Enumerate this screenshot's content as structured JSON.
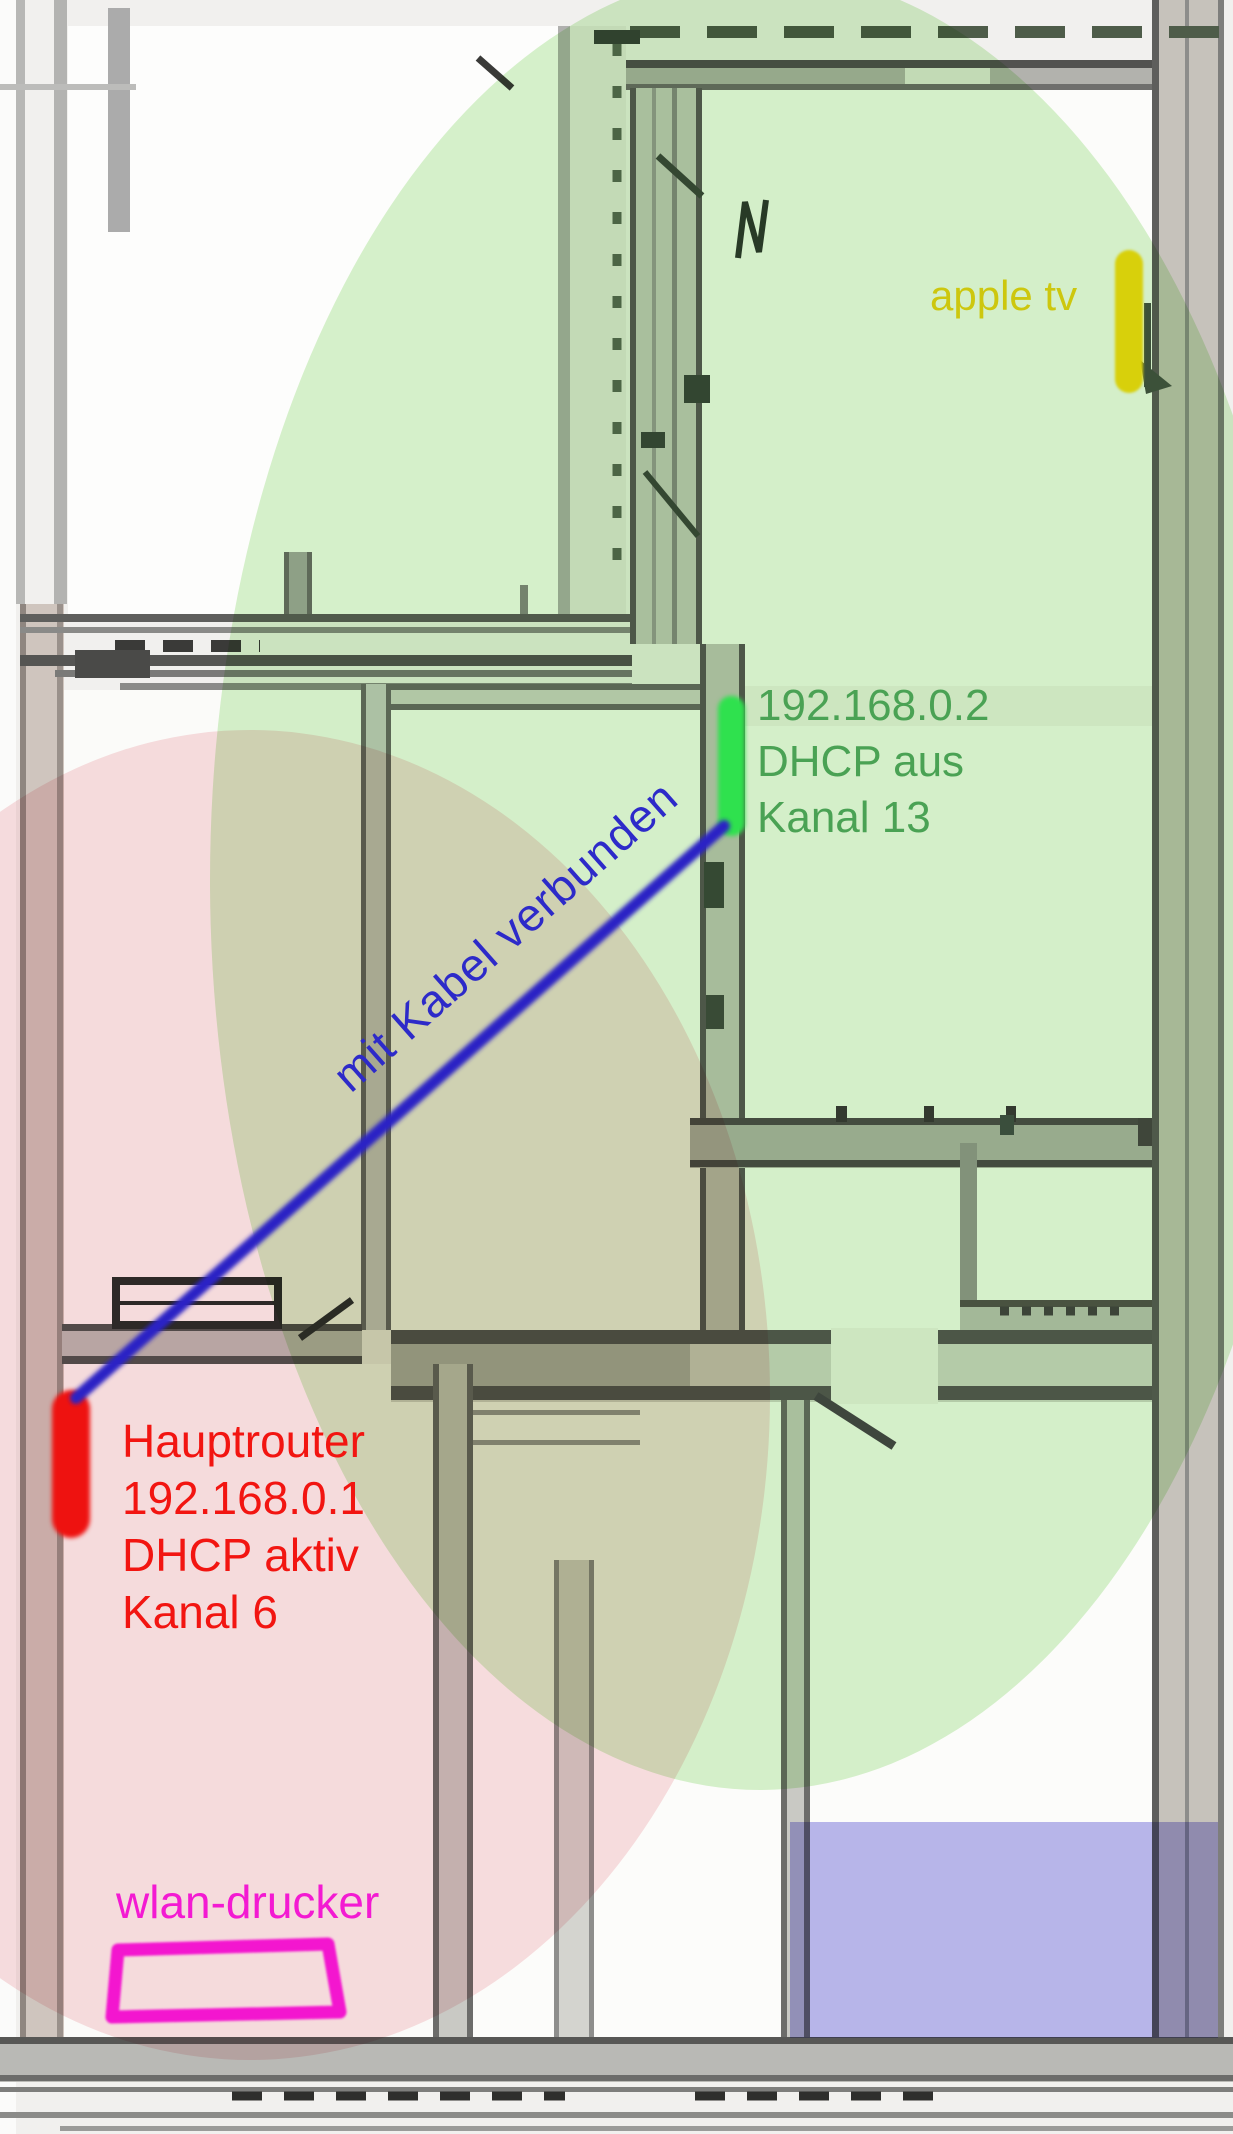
{
  "zones": {
    "router2_wlan": {
      "name": "WLAN coverage second router",
      "color": "#d7f2cd"
    },
    "router1_wlan": {
      "name": "WLAN coverage main router",
      "color": "#f9dfe2"
    },
    "blue_room": {
      "name": "blue highlighted room",
      "color": "#b9b7ee"
    }
  },
  "annotations": {
    "apple_tv": {
      "label": "apple tv",
      "color": "#cdc70e",
      "marker_color": "#d8d00b"
    },
    "router2": {
      "lines": [
        "192.168.0.2",
        "DHCP aus",
        "Kanal 13"
      ],
      "color": "#4aa254",
      "marker_color": "#2fe14e"
    },
    "cable": {
      "label": "mit Kabel verbunden",
      "color": "#2d2ac9",
      "line_color": "#2b22c5"
    },
    "router1": {
      "lines": [
        "Hauptrouter",
        "192.168.0.1",
        "DHCP aktiv",
        "Kanal 6"
      ],
      "color": "#f21511",
      "marker_color": "#ee1210"
    },
    "printer": {
      "label": "wlan-drucker",
      "color": "#f31ad2",
      "outline_color": "#f318cf"
    }
  }
}
